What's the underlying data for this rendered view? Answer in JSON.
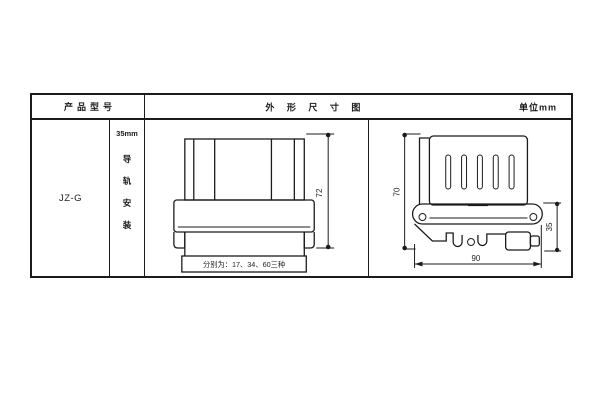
{
  "table": {
    "header": {
      "product_model_label": "产品型号",
      "dimension_diagram_label": "外 形 尺 寸 图",
      "unit_label": "单位mm"
    },
    "model": "JZ-G",
    "mounting": {
      "rail_size": "35mm",
      "chars": [
        "导",
        "轨",
        "安",
        "装"
      ]
    }
  },
  "front_view": {
    "height_dim": "72",
    "width_note": "分别为：17、34、60三种"
  },
  "side_view": {
    "height_dim": "70",
    "bottom_dim": "90",
    "clamp_dim": "35"
  },
  "colors": {
    "line": "#1b1b1b",
    "background": "#ffffff"
  }
}
